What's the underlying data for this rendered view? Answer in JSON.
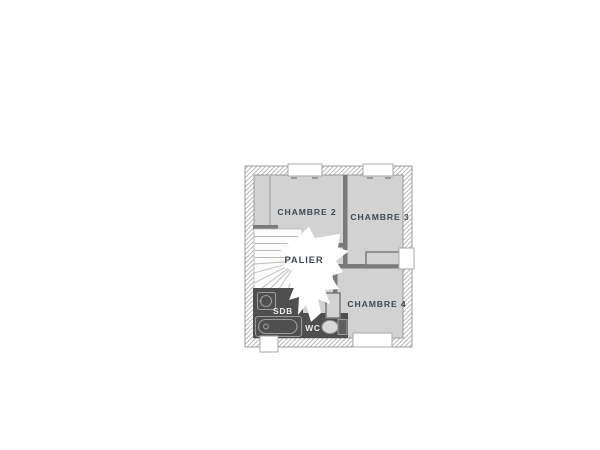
{
  "floorplan": {
    "rooms": [
      {
        "id": "chambre-2",
        "label": "CHAMBRE 2"
      },
      {
        "id": "chambre-3",
        "label": "CHAMBRE 3"
      },
      {
        "id": "chambre-4",
        "label": "CHAMBRE 4"
      },
      {
        "id": "palier",
        "label": "PALIER"
      },
      {
        "id": "sdb",
        "label": "SDB"
      },
      {
        "id": "wc",
        "label": "WC"
      }
    ],
    "colors": {
      "room_fill": "#d2d2d2",
      "wall_dark": "#7b7b7b",
      "wall_line": "#9b9b9b",
      "hatch_line": "#b3b3b3",
      "sanitary_fill": "#4f4f4f",
      "fixture_line": "#9a9a9a",
      "stair_line": "#bcbcbc",
      "label_dark": "#3d4a53",
      "label_light": "#ededed"
    }
  }
}
